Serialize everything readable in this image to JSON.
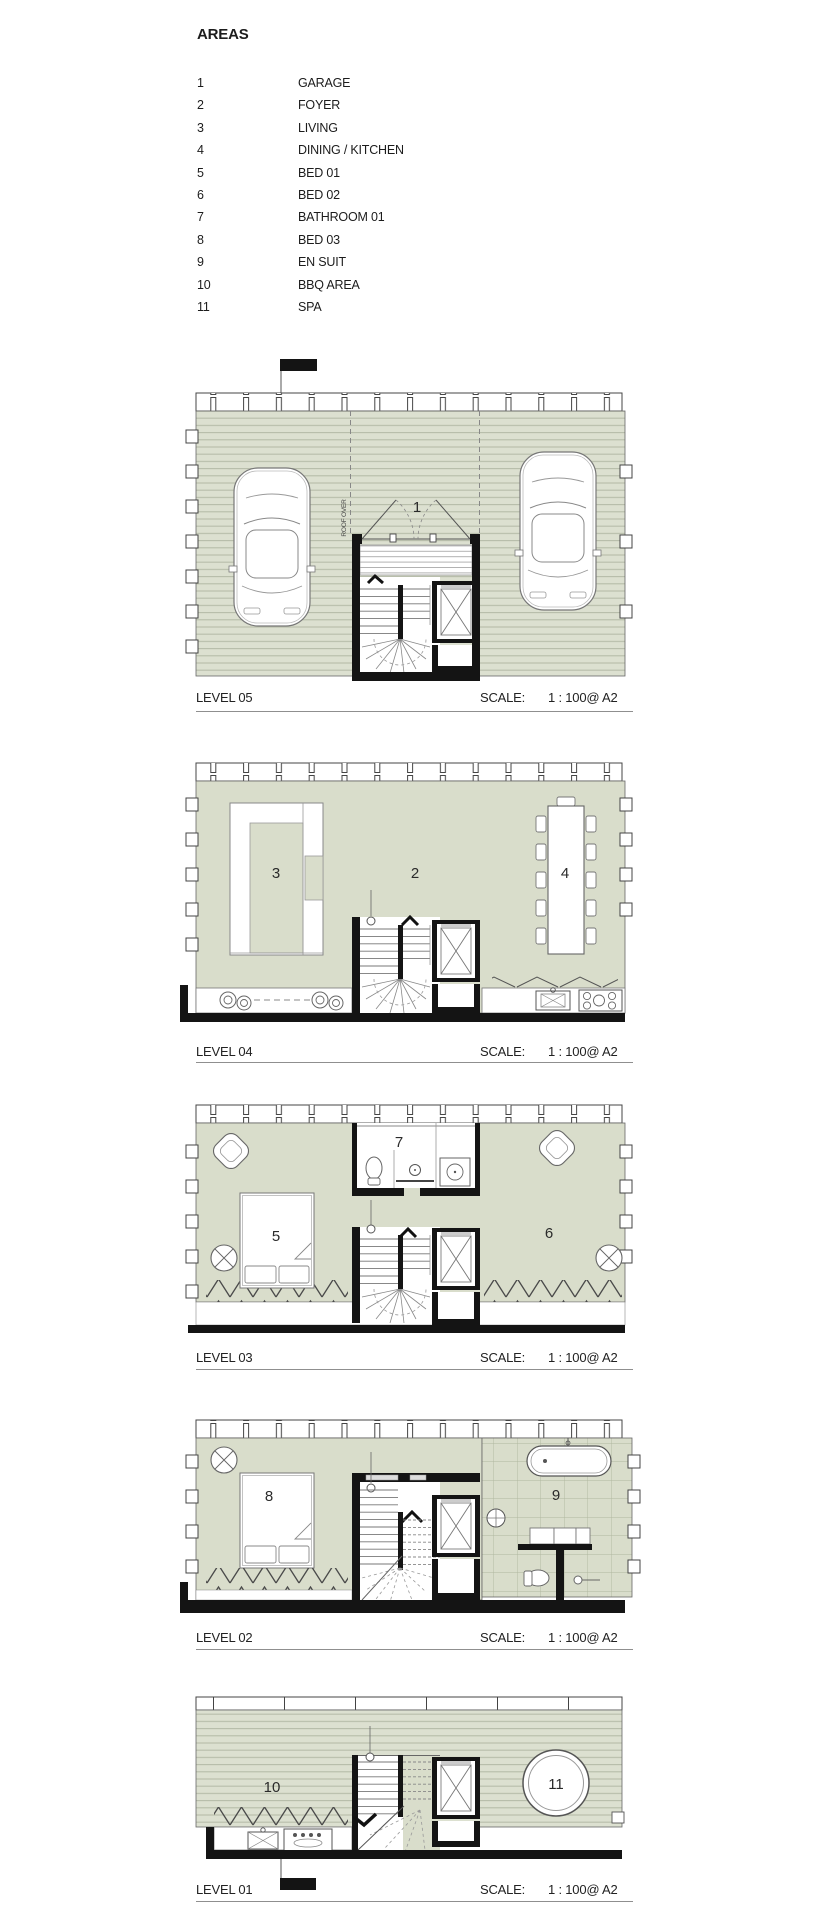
{
  "doc": {
    "type": "architectural floor plan sheet"
  },
  "colors": {
    "floor": "#d9ddcb",
    "deck": "#dce0d0",
    "deck_line": "#b6bca8",
    "tile_line": "#b0b69f",
    "wall": "#141414"
  },
  "legend": {
    "title": "AREAS",
    "items": [
      {
        "num": "1",
        "label": "GARAGE"
      },
      {
        "num": "2",
        "label": "FOYER"
      },
      {
        "num": "3",
        "label": "LIVING"
      },
      {
        "num": "4",
        "label": "DINING / KITCHEN"
      },
      {
        "num": "5",
        "label": "BED 01"
      },
      {
        "num": "6",
        "label": "BED 02"
      },
      {
        "num": "7",
        "label": "BATHROOM 01"
      },
      {
        "num": "8",
        "label": "BED 03"
      },
      {
        "num": "9",
        "label": "EN SUIT"
      },
      {
        "num": "10",
        "label": "BBQ AREA"
      },
      {
        "num": "11",
        "label": "SPA"
      }
    ]
  },
  "scale": {
    "label": "SCALE:",
    "value": "1 : 100@ A2"
  },
  "levels": [
    {
      "name": "LEVEL 05",
      "labels": {
        "garage": "1"
      },
      "note_roof": "ROOF OVER"
    },
    {
      "name": "LEVEL 04",
      "labels": {
        "foyer": "2",
        "living": "3",
        "dining": "4"
      }
    },
    {
      "name": "LEVEL 03",
      "labels": {
        "bed01": "5",
        "bed02": "6",
        "bathroom": "7"
      }
    },
    {
      "name": "LEVEL 02",
      "labels": {
        "bed03": "8",
        "ensuite": "9"
      }
    },
    {
      "name": "LEVEL 01",
      "labels": {
        "bbq": "10",
        "spa": "11"
      }
    }
  ]
}
